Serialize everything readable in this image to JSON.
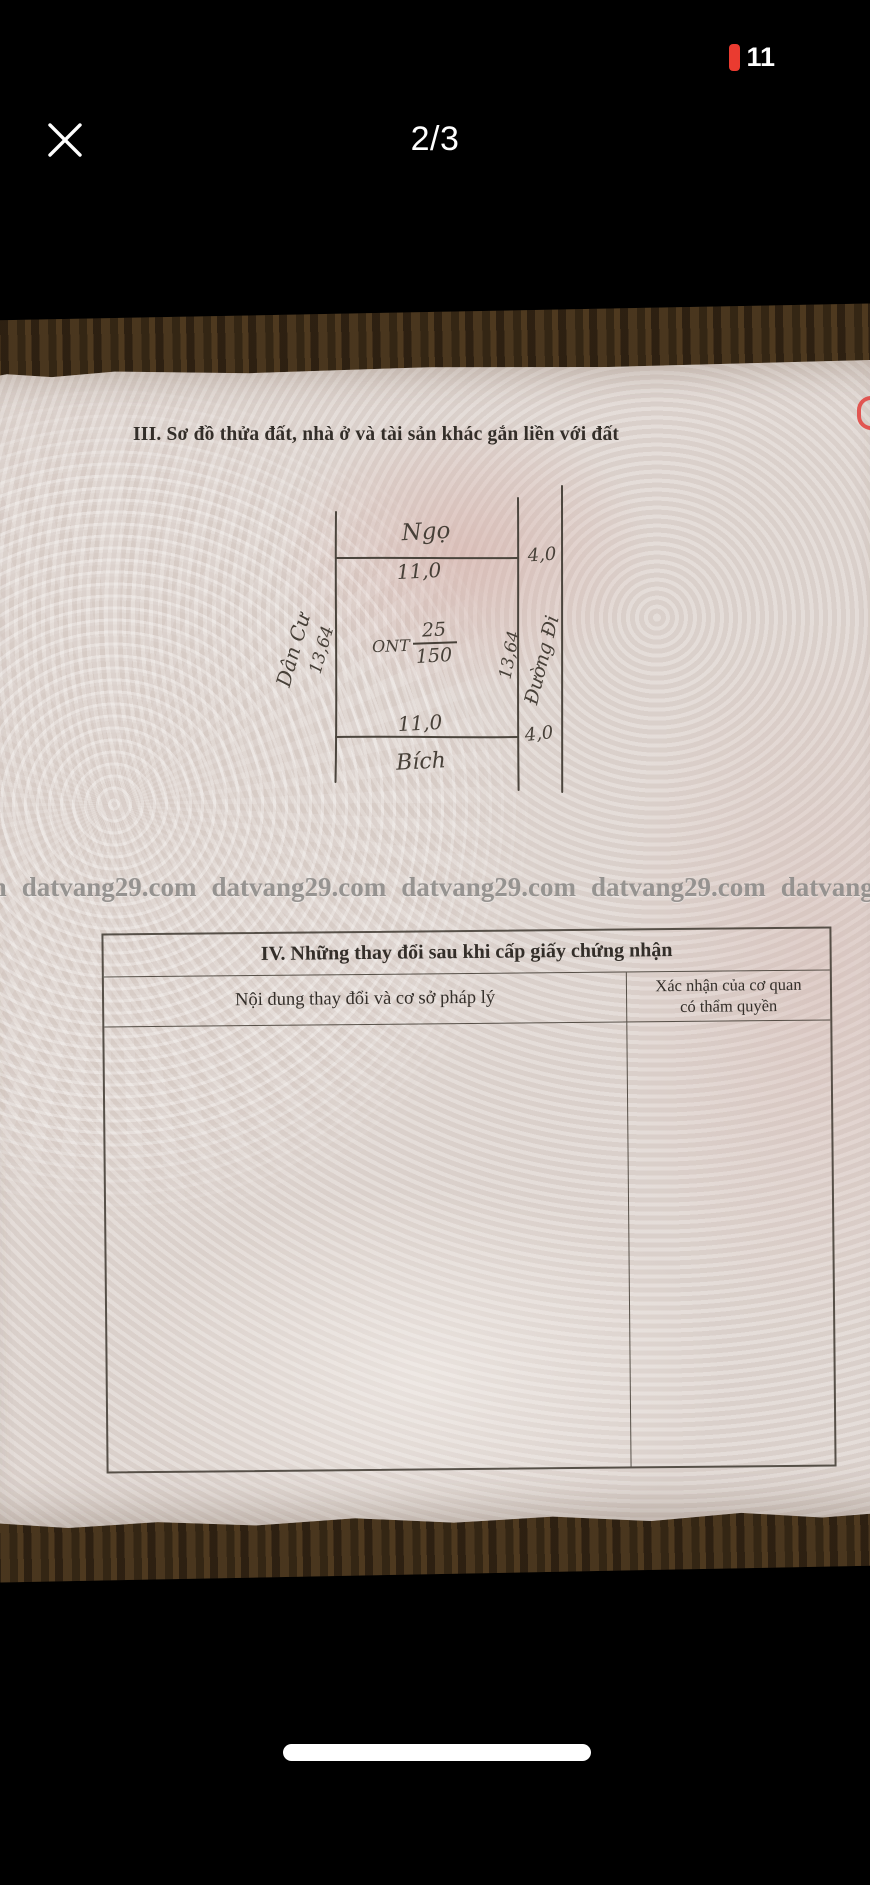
{
  "status_bar": {
    "battery_percent": "11"
  },
  "viewer": {
    "page_indicator": "2/3"
  },
  "document": {
    "section3": {
      "title": "III. Sơ đồ thửa đất, nhà ở và tài sản khác gắn liền với đất"
    },
    "diagram": {
      "north_neighbor": "Ngọ",
      "south_neighbor": "Bích",
      "west_neighbor": "Dân Cư",
      "road_label": "Đường Đi",
      "top_edge_length": "11,0",
      "bottom_edge_length": "11,0",
      "left_edge_length": "13,64",
      "right_edge_length": "13,64",
      "road_top_width": "4,0",
      "road_bottom_width": "4,0",
      "land_use_code": "ONT",
      "parcel_number": "25",
      "parcel_area": "150"
    },
    "watermark": {
      "text": "datvang29.com"
    },
    "section4": {
      "title": "IV. Những thay đổi sau khi cấp giấy chứng nhận",
      "col1_header": "Nội dung thay đổi và cơ sở pháp lý",
      "col2_header_line1": "Xác nhận của cơ quan",
      "col2_header_line2": "có thẩm quyền"
    }
  },
  "colors": {
    "battery_low": "#ea3b30",
    "paper": "#e0d7d2",
    "ink": "#474038"
  }
}
